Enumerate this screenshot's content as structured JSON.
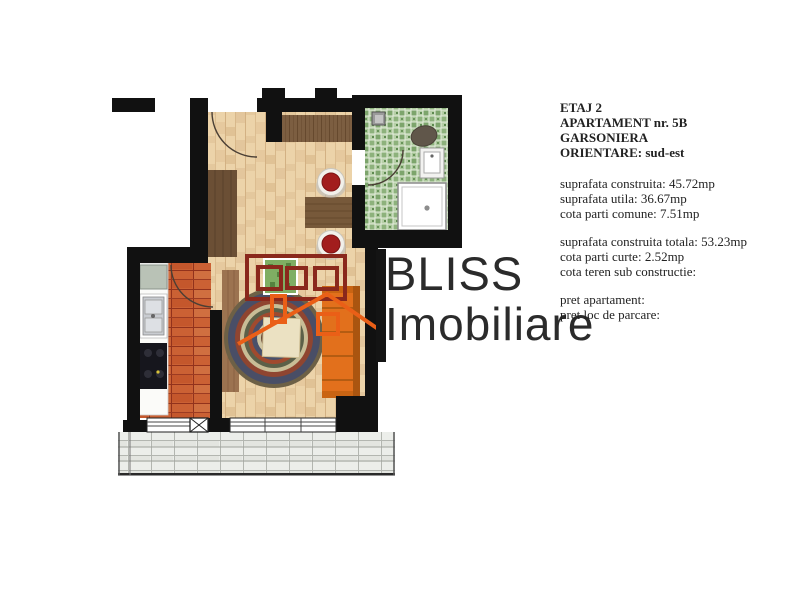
{
  "logo": {
    "name": "BLISS",
    "tagline": "Imobiliare",
    "mark": "house-icon",
    "colors": {
      "dark_red": "#8a281c",
      "orange": "#ea5f17",
      "bar": "#141414"
    }
  },
  "panel": {
    "floor": "ETAJ 2",
    "apartment": "APARTAMENT nr. 5B",
    "unit_type": "GARSONIERA",
    "orientation": "ORIENTARE: sud-est",
    "area_lines": [
      "suprafata construita: 45.72mp",
      "suprafata utila: 36.67mp",
      "cota parti comune: 7.51mp"
    ],
    "total_lines": [
      "suprafata construita totala: 53.23mp",
      "cota parti curte: 2.52mp",
      "cota teren sub constructie:"
    ],
    "price_lines": [
      "pret apartament:",
      "pret loc de parcare:"
    ]
  },
  "floor_plan": {
    "rooms": [
      "living-room",
      "kitchen",
      "bathroom",
      "balcony",
      "entry-hall"
    ],
    "colors": {
      "wall": "#111111",
      "wood_floor": "#ecd3a9",
      "kitchen_tile": "#cb6134",
      "bath_mosaic": "#8db27c",
      "sofa_orange": "#e2701c",
      "chair_red": "#a21d1d",
      "balcony_tile": "#eceeea"
    }
  }
}
